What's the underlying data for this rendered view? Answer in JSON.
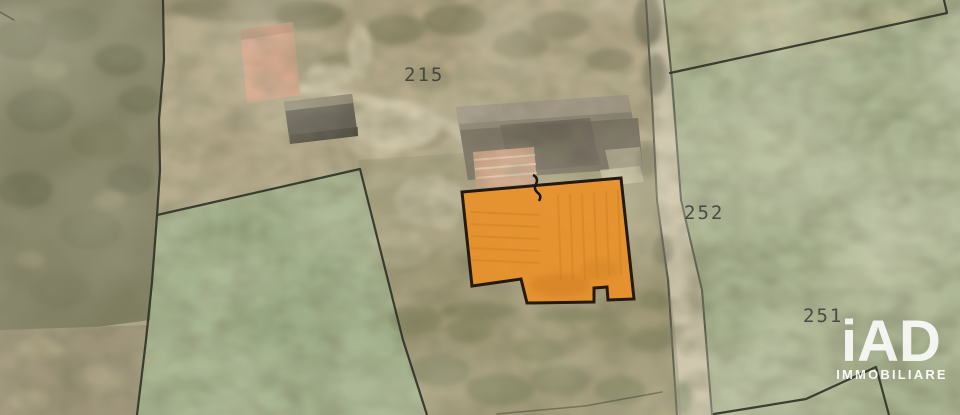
{
  "map": {
    "type": "cadastral-aerial-map",
    "parcel_labels": [
      {
        "id": "parcel-215",
        "text": "215"
      },
      {
        "id": "parcel-252",
        "text": "252"
      },
      {
        "id": "parcel-251",
        "text": "251"
      }
    ],
    "highlight": {
      "description": "highlighted-building-footprint",
      "fill": "#E8912C",
      "border": "#241A10"
    },
    "colors": {
      "field_green": "#A8B290",
      "meadow_green": "#9DAD87",
      "woods": "#7B7A5D",
      "farmland_tan": "#AFA383",
      "road": "#C8C0A6",
      "boundary_line": "#2E3226",
      "label_text": "#3D3D38"
    }
  },
  "watermark": {
    "brand": "iAD",
    "subtitle": "IMMOBILIARE",
    "color": "#FFFFFF"
  }
}
